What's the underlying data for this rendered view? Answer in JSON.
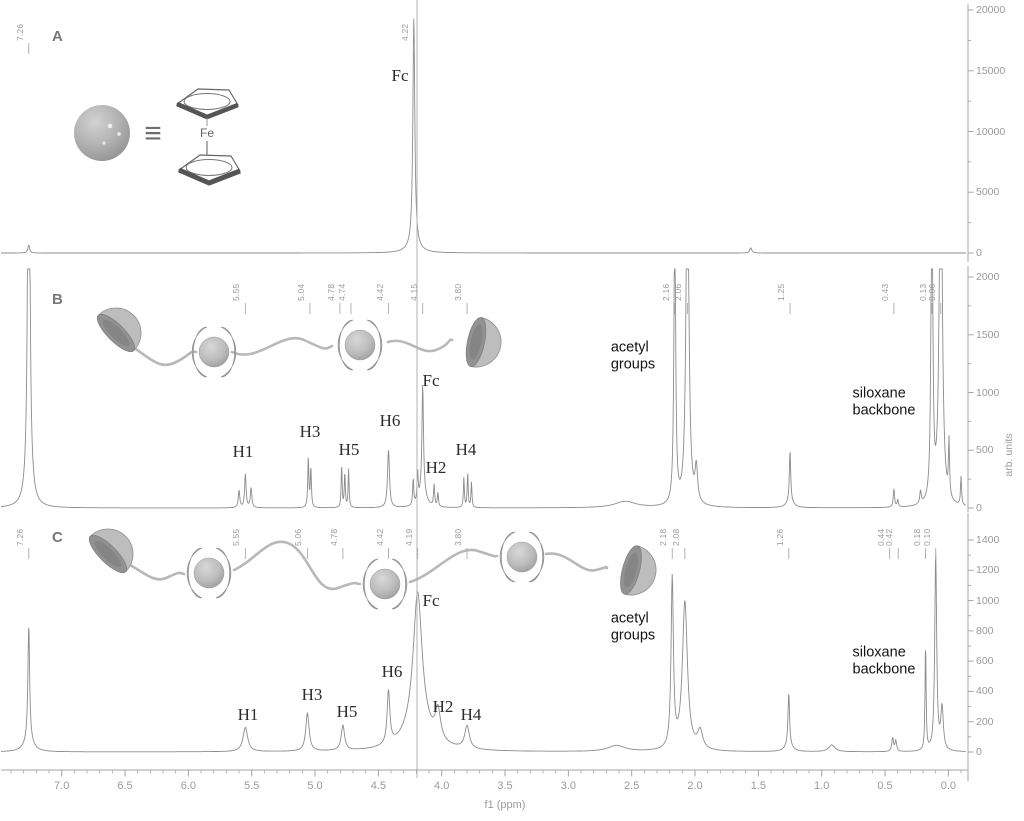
{
  "figure": {
    "xlabel": "f1 (ppm)",
    "ylabel": "arb. units",
    "equivalence_symbol": "≡",
    "iron_label": "Fe",
    "crosshair_ppm": 4.2,
    "line_color": "#8c8c8c",
    "axis_color": "#a5a5a5",
    "tick_text_color": "#9a9a9a",
    "x_ticks": [
      "7.0",
      "6.5",
      "6.0",
      "5.5",
      "5.0",
      "4.5",
      "4.0",
      "3.5",
      "3.0",
      "2.5",
      "2.0",
      "1.5",
      "1.0",
      "0.5",
      "0.0"
    ]
  },
  "chart_data": [
    {
      "type": "line",
      "panel_label": "A",
      "description": "1H NMR spectrum of ferrocene reference",
      "icons": [
        "ferrocene-sphere-icon",
        "equivalence-symbol",
        "ferrocene-structure-icon"
      ],
      "ylim": [
        0,
        20000
      ],
      "y_ticks": [
        0,
        5000,
        10000,
        15000,
        20000
      ],
      "peak_labels": [
        {
          "ppm": 7.26,
          "label": "7.26",
          "dx": 0
        },
        {
          "ppm": 4.22,
          "label": "4.22",
          "dx": 0
        }
      ],
      "annotations": [
        {
          "text": "Fc",
          "x": 400,
          "y": 76,
          "style": "serif"
        }
      ],
      "peaks": [
        [
          7.26,
          650,
          0.008
        ],
        [
          4.22,
          18600,
          0.009
        ],
        [
          4.22,
          700,
          0.05
        ],
        [
          1.56,
          430,
          0.01
        ]
      ]
    },
    {
      "type": "line",
      "panel_label": "B",
      "description": "1H NMR spectrum of siloxane polymer with two threaded cyclodextrin beads",
      "icons": [
        "polymer-chain-cartoon",
        "cyclodextrin-bead-icon",
        "cyclodextrin-cup-icon"
      ],
      "ylim": [
        0,
        2000
      ],
      "y_ticks": [
        0,
        500,
        1000,
        1500,
        2000
      ],
      "peak_labels": [
        {
          "ppm": 5.55,
          "label": "5.55",
          "dx": 0
        },
        {
          "ppm": 5.04,
          "label": "5.04",
          "dx": 0
        },
        {
          "ppm": 4.78,
          "label": "4.78",
          "dx": -3
        },
        {
          "ppm": 4.74,
          "label": "4.74",
          "dx": 3
        },
        {
          "ppm": 4.42,
          "label": "4.42",
          "dx": 0
        },
        {
          "ppm": 4.15,
          "label": "4.15",
          "dx": 0
        },
        {
          "ppm": 3.8,
          "label": "3.80",
          "dx": 0
        },
        {
          "ppm": 2.16,
          "label": "2.16",
          "dx": 0
        },
        {
          "ppm": 2.06,
          "label": "2.06",
          "dx": 0
        },
        {
          "ppm": 1.25,
          "label": "1.25",
          "dx": 0
        },
        {
          "ppm": 0.43,
          "label": "0.43",
          "dx": 0
        },
        {
          "ppm": 0.13,
          "label": "0.13",
          "dx": 0
        },
        {
          "ppm": 0.06,
          "label": "0.06",
          "dx": 0
        }
      ],
      "annotations": [
        {
          "text": "Fc",
          "x": 431,
          "y": 381,
          "style": "serif"
        },
        {
          "text": "H1",
          "x": 243,
          "y": 452,
          "style": "serif"
        },
        {
          "text": "H3",
          "x": 310,
          "y": 432,
          "style": "serif"
        },
        {
          "text": "H5",
          "x": 349,
          "y": 450,
          "style": "serif"
        },
        {
          "text": "H6",
          "x": 390,
          "y": 421,
          "style": "serif"
        },
        {
          "text": "H2",
          "x": 436,
          "y": 468,
          "style": "serif"
        },
        {
          "text": "H4",
          "x": 466,
          "y": 450,
          "style": "serif"
        },
        {
          "text": "acetyl\ngroups",
          "x": 633,
          "y": 357,
          "style": "sans"
        },
        {
          "text": "siloxane\nbackbone",
          "x": 884,
          "y": 403,
          "style": "sans"
        }
      ],
      "peaks": [
        [
          7.26,
          5000,
          0.008
        ],
        [
          7.26,
          300,
          0.03
        ],
        [
          5.6,
          150,
          0.007
        ],
        [
          5.55,
          290,
          0.007
        ],
        [
          5.505,
          170,
          0.007
        ],
        [
          5.053,
          430,
          0.005
        ],
        [
          5.033,
          340,
          0.005
        ],
        [
          4.79,
          370,
          0.0045
        ],
        [
          4.765,
          300,
          0.0045
        ],
        [
          4.735,
          330,
          0.0045
        ],
        [
          4.42,
          500,
          0.009
        ],
        [
          4.225,
          230,
          0.005
        ],
        [
          4.19,
          260,
          0.005
        ],
        [
          4.15,
          920,
          0.007
        ],
        [
          4.15,
          150,
          0.03
        ],
        [
          4.06,
          190,
          0.005
        ],
        [
          4.03,
          120,
          0.005
        ],
        [
          3.825,
          260,
          0.0045
        ],
        [
          3.795,
          300,
          0.0045
        ],
        [
          3.765,
          220,
          0.0045
        ],
        [
          2.55,
          55,
          0.1
        ],
        [
          2.16,
          2600,
          0.008
        ],
        [
          2.06,
          3200,
          0.013
        ],
        [
          1.99,
          300,
          0.012
        ],
        [
          1.25,
          440,
          0.006
        ],
        [
          1.25,
          60,
          0.03
        ],
        [
          0.43,
          160,
          0.006
        ],
        [
          0.4,
          60,
          0.006
        ],
        [
          0.22,
          110,
          0.007
        ],
        [
          0.13,
          3000,
          0.008
        ],
        [
          0.06,
          3600,
          0.013
        ],
        [
          -0.005,
          480,
          0.005
        ],
        [
          -0.1,
          250,
          0.005
        ]
      ]
    },
    {
      "type": "line",
      "panel_label": "C",
      "description": "1H NMR spectrum of siloxane polymer with three threaded cyclodextrin beads",
      "icons": [
        "polymer-chain-cartoon",
        "cyclodextrin-bead-icon",
        "cyclodextrin-cup-icon"
      ],
      "ylim": [
        0,
        1400
      ],
      "y_ticks": [
        0,
        200,
        400,
        600,
        800,
        1000,
        1200,
        1400
      ],
      "peak_labels": [
        {
          "ppm": 7.26,
          "label": "7.26",
          "dx": 0
        },
        {
          "ppm": 5.55,
          "label": "5.55",
          "dx": 0
        },
        {
          "ppm": 5.06,
          "label": "5.06",
          "dx": 0
        },
        {
          "ppm": 4.78,
          "label": "4.78",
          "dx": 0
        },
        {
          "ppm": 4.42,
          "label": "4.42",
          "dx": 0
        },
        {
          "ppm": 4.19,
          "label": "4.19",
          "dx": 0
        },
        {
          "ppm": 3.8,
          "label": "3.80",
          "dx": 0
        },
        {
          "ppm": 2.18,
          "label": "2.18",
          "dx": 0
        },
        {
          "ppm": 2.08,
          "label": "2.08",
          "dx": 0
        },
        {
          "ppm": 1.26,
          "label": "1.26",
          "dx": 0
        },
        {
          "ppm": 0.44,
          "label": "0.44",
          "dx": -3
        },
        {
          "ppm": 0.42,
          "label": "0.42",
          "dx": 3
        },
        {
          "ppm": 0.18,
          "label": "0.18",
          "dx": 0
        },
        {
          "ppm": 0.1,
          "label": "0.10",
          "dx": 0
        }
      ],
      "annotations": [
        {
          "text": "Fc",
          "x": 431,
          "y": 601,
          "style": "serif"
        },
        {
          "text": "H1",
          "x": 248,
          "y": 715,
          "style": "serif"
        },
        {
          "text": "H3",
          "x": 312,
          "y": 695,
          "style": "serif"
        },
        {
          "text": "H5",
          "x": 347,
          "y": 712,
          "style": "serif"
        },
        {
          "text": "H6",
          "x": 392,
          "y": 672,
          "style": "serif"
        },
        {
          "text": "H2",
          "x": 443,
          "y": 707,
          "style": "serif"
        },
        {
          "text": "H4",
          "x": 471,
          "y": 715,
          "style": "serif"
        },
        {
          "text": "acetyl\ngroups",
          "x": 633,
          "y": 628,
          "style": "sans"
        },
        {
          "text": "siloxane\nbackbone",
          "x": 884,
          "y": 662,
          "style": "sans"
        }
      ],
      "peaks": [
        [
          7.26,
          760,
          0.008
        ],
        [
          7.26,
          80,
          0.04
        ],
        [
          5.55,
          160,
          0.022
        ],
        [
          5.06,
          250,
          0.016
        ],
        [
          4.78,
          165,
          0.016
        ],
        [
          4.42,
          350,
          0.013
        ],
        [
          4.19,
          900,
          0.042
        ],
        [
          4.19,
          150,
          0.12
        ],
        [
          4.03,
          200,
          0.025
        ],
        [
          3.8,
          150,
          0.022
        ],
        [
          2.62,
          40,
          0.08
        ],
        [
          2.18,
          1120,
          0.011
        ],
        [
          2.08,
          980,
          0.024
        ],
        [
          1.96,
          120,
          0.025
        ],
        [
          1.26,
          340,
          0.007
        ],
        [
          1.26,
          50,
          0.03
        ],
        [
          0.92,
          45,
          0.03
        ],
        [
          0.44,
          90,
          0.008
        ],
        [
          0.415,
          70,
          0.008
        ],
        [
          0.18,
          700,
          0.005
        ],
        [
          0.1,
          1300,
          0.009
        ],
        [
          0.05,
          280,
          0.012
        ]
      ]
    }
  ]
}
